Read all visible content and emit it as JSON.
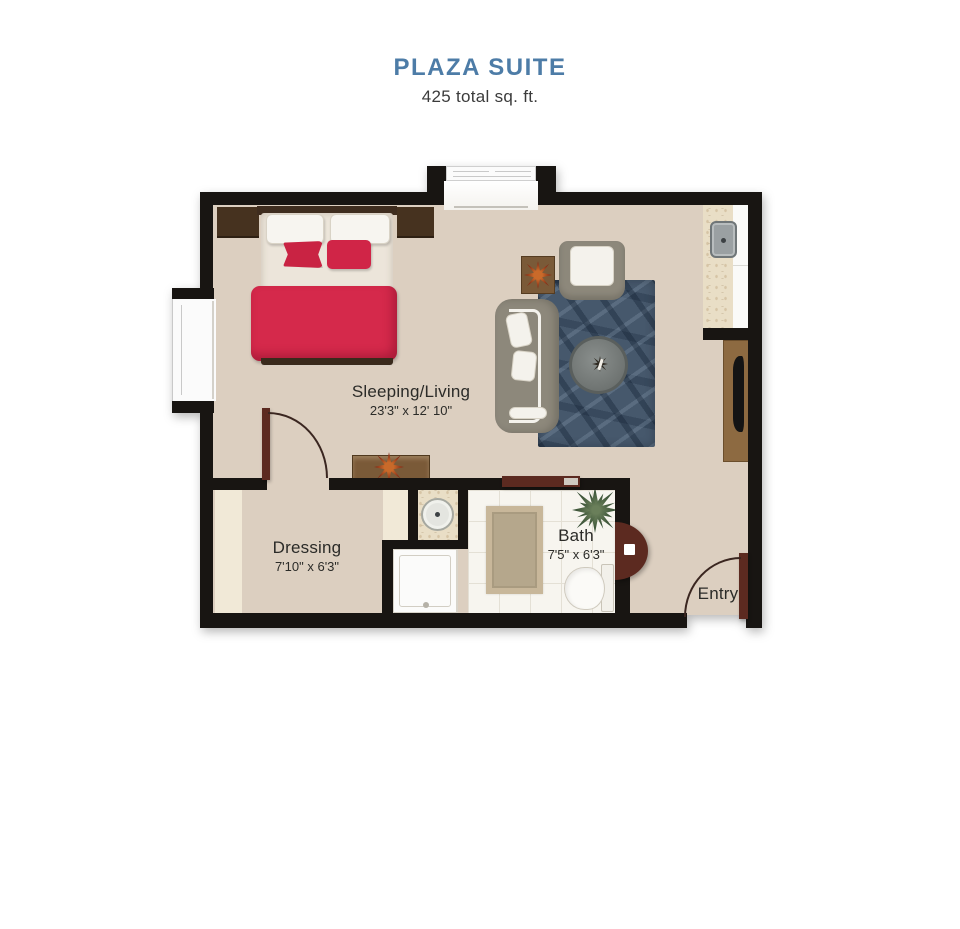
{
  "header": {
    "title": "PLAZA SUITE",
    "subtitle": "425 total sq. ft."
  },
  "rooms": {
    "sleeping_living": {
      "label": "Sleeping/Living",
      "dimensions": "23'3\" x 12' 10\""
    },
    "dressing": {
      "label": "Dressing",
      "dimensions": "7'10\" x 6'3\""
    },
    "bath": {
      "label": "Bath",
      "dimensions": "7'5\" x 6'3\""
    },
    "entry": {
      "label": "Entry"
    }
  },
  "furniture": [
    "bed",
    "nightstand-left",
    "nightstand-right",
    "sofa",
    "armchair",
    "round-coffee-table",
    "area-rug",
    "side-table-with-plant",
    "console-table-with-plant",
    "tv-console",
    "tv",
    "kitchenette-counter",
    "kitchenette-sink",
    "vanity-sink",
    "shower",
    "toilet",
    "bath-rug",
    "bath-plant",
    "entry-door",
    "dressing-door",
    "bath-sliding-door",
    "windows"
  ],
  "colors": {
    "accent": "#4d7ca7",
    "wall": "#181512",
    "floor": "#dccfc0",
    "closet": "#f1e9d7",
    "bed_red": "#d5294b",
    "door_maroon": "#5c2a20",
    "rug_blue": "#46586c",
    "wood_medium": "#7a5a38",
    "wood_console": "#8d6a41",
    "sofa_gray": "#8d887b",
    "tile": "#f7f5ef",
    "marble": "#e9dec6",
    "label": "#2b2b28"
  }
}
